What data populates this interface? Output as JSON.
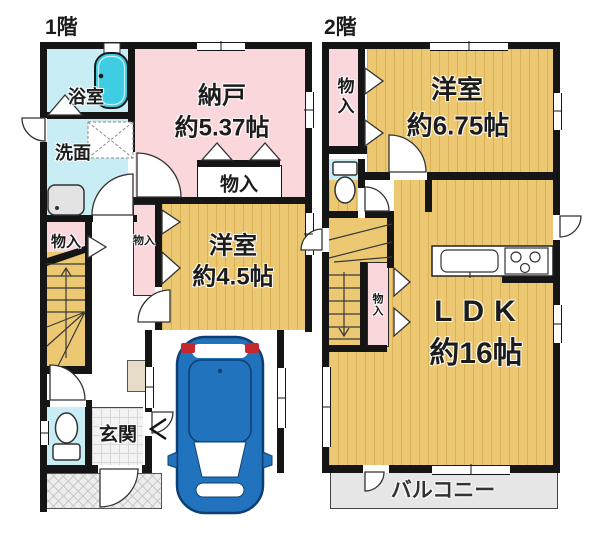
{
  "floor1": {
    "title": "1階",
    "rooms": {
      "bath": "浴室",
      "senmen": "洗面",
      "nando_name": "納戸",
      "nando_size": "約5.37帖",
      "mono_box": "物入",
      "mono_left": "物入",
      "mono_mid": "物入",
      "yoshitsu_name": "洋室",
      "yoshitsu_size": "約4.5帖",
      "genkan": "玄関"
    }
  },
  "floor2": {
    "title": "2階",
    "rooms": {
      "mono_top": "物入",
      "yoshitsu_name": "洋室",
      "yoshitsu_size": "約6.75帖",
      "mono_mid": "物入",
      "ldk_name": "LDK",
      "ldk_size": "約16帖",
      "balcony": "バルコニー"
    }
  },
  "colors": {
    "wall": "#151515",
    "room_pink": "#f9d7da",
    "room_tan": "#ecc873",
    "room_cyan": "#c9edf4",
    "bathtub_cyan": "#3fcde4",
    "balcony_gray": "#e6e6e6",
    "entrance_gray": "#f3f3f3",
    "car_blue": "#2273be",
    "car_red": "#c5282f"
  }
}
